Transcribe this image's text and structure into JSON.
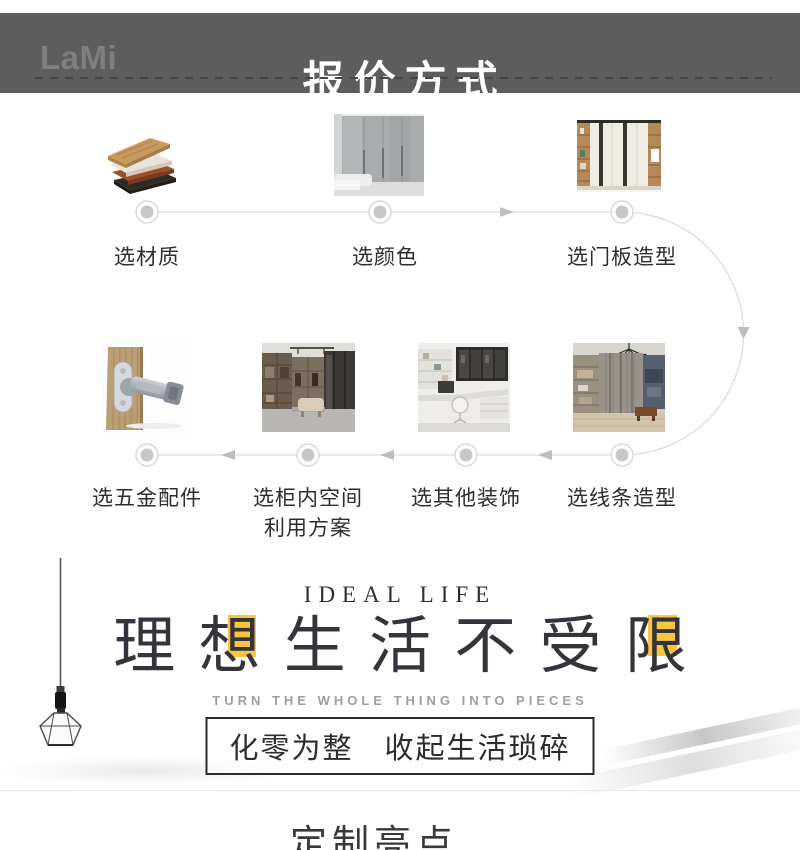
{
  "header": {
    "logo": "LaMi",
    "title": "报价方式",
    "bar_color": "#5d5d5d"
  },
  "flow": {
    "top_steps": [
      {
        "label": "选材质",
        "image": "material-samples"
      },
      {
        "label": "选颜色",
        "image": "gray-wardrobe-color"
      },
      {
        "label": "选门板造型",
        "image": "door-panel-wardrobe"
      }
    ],
    "bottom_steps": [
      {
        "label": "选五金配件",
        "image": "hinge-hardware"
      },
      {
        "label": "选柜内空间",
        "label_line2": "利用方案",
        "image": "walk-in-closet"
      },
      {
        "label": "选其他装饰",
        "image": "study-corner"
      },
      {
        "label": "选线条造型",
        "image": "wardrobe-chandelier"
      }
    ]
  },
  "hero": {
    "eyebrow": "IDEAL LIFE",
    "chars": [
      "理",
      "想",
      "生",
      "活",
      "不",
      "受",
      "限"
    ],
    "subtitle": "TURN THE WHOLE THING INTO PIECES",
    "slogan": "化零为整　收起生活琐碎",
    "accent_color": "#f9c440"
  },
  "footer": {
    "title": "定制亮点"
  }
}
